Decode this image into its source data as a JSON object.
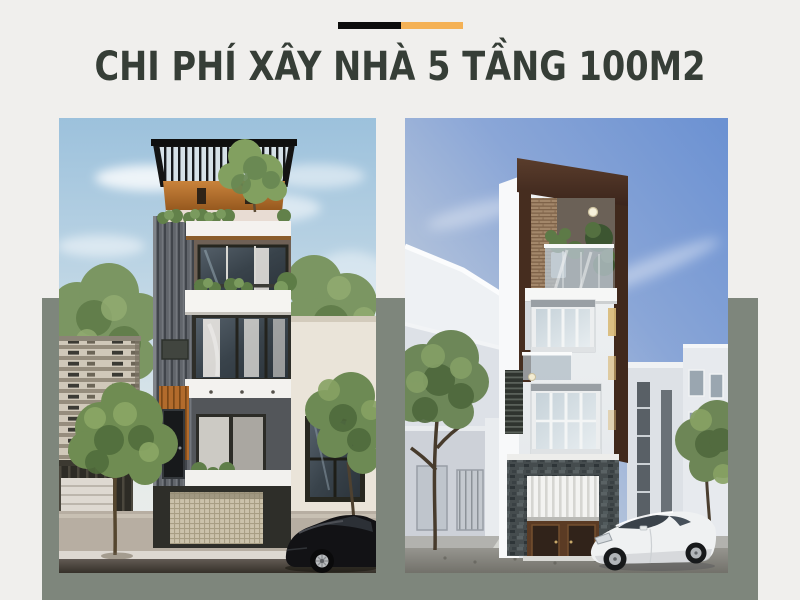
{
  "theme": {
    "bg": "#f0efed",
    "band": "#7e867c",
    "title_color": "#363e37",
    "bar_black": "#0c0c0c",
    "bar_orange": "#f4b155"
  },
  "header": {
    "title": "CHI PHÍ XÂY NHÀ 5 TẦNG 100M2"
  },
  "photos": {
    "left_name": "modern-townhouse-rendering",
    "right_name": "narrow-white-townhouse-rendering"
  }
}
